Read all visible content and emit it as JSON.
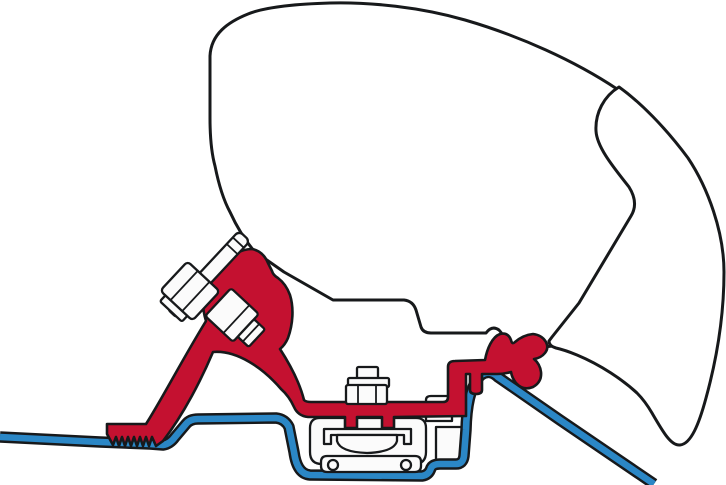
{
  "diagram": {
    "title": "awning-roof-adapter-cross-section",
    "description": "Technical cross-section drawing: awning cassette profile mounted to a vehicle roof via a red adapter bracket clamped to the roof rail",
    "background": "#ffffff",
    "colors": {
      "line": "#17191b",
      "case_fill": "#ffffff",
      "bracket_red": "#c41130",
      "roof_blue": "#2b87c6",
      "hardware_fill": "#fbfbfb"
    },
    "components": [
      {
        "id": "awning-case-body",
        "label": "Awning cassette housing profile"
      },
      {
        "id": "awning-case-front-cover",
        "label": "Awning cassette front cover profile"
      },
      {
        "id": "roof-profile",
        "label": "Vehicle roof sheet profile"
      },
      {
        "id": "adapter-bracket",
        "label": "Red adapter bracket with serrated foot"
      },
      {
        "id": "rail-clamp",
        "label": "Roof rail clamp block with base plate holes"
      },
      {
        "id": "mounting-plate",
        "label": "Angled mounting plate"
      },
      {
        "id": "hex-bolt",
        "label": "Hex bolt with washer"
      },
      {
        "id": "square-bolt",
        "label": "Square-head bolt through bracket window"
      },
      {
        "id": "center-bolt",
        "label": "Clamp stud with nut and washer"
      }
    ]
  }
}
